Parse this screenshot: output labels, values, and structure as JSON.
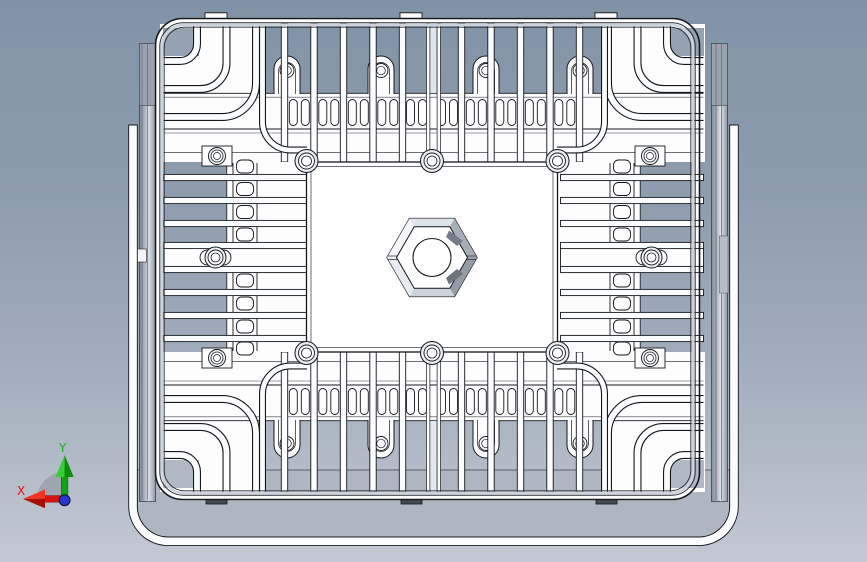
{
  "viewport": {
    "type": "cad-3d-view",
    "background_top": "#8093a6",
    "background_bottom": "#c3c9d3",
    "outline_color": "#14171c",
    "metal_color": "#fdfdfe",
    "shaded_metal_color": "#aeb6c2"
  },
  "model": {
    "name": "led-floodlight-heatsink-back-view",
    "parts": [
      "mounting-bracket-yoke",
      "heatsink-body",
      "vertical-fins",
      "horizontal-fins",
      "corner-fins",
      "center-plate",
      "hex-boss",
      "screws"
    ]
  },
  "triad": {
    "x": {
      "label": "X",
      "color": "#e11515"
    },
    "y": {
      "label": "Y",
      "color": "#17b517"
    },
    "z": {
      "label": "Z",
      "color": "#2438cf"
    }
  }
}
